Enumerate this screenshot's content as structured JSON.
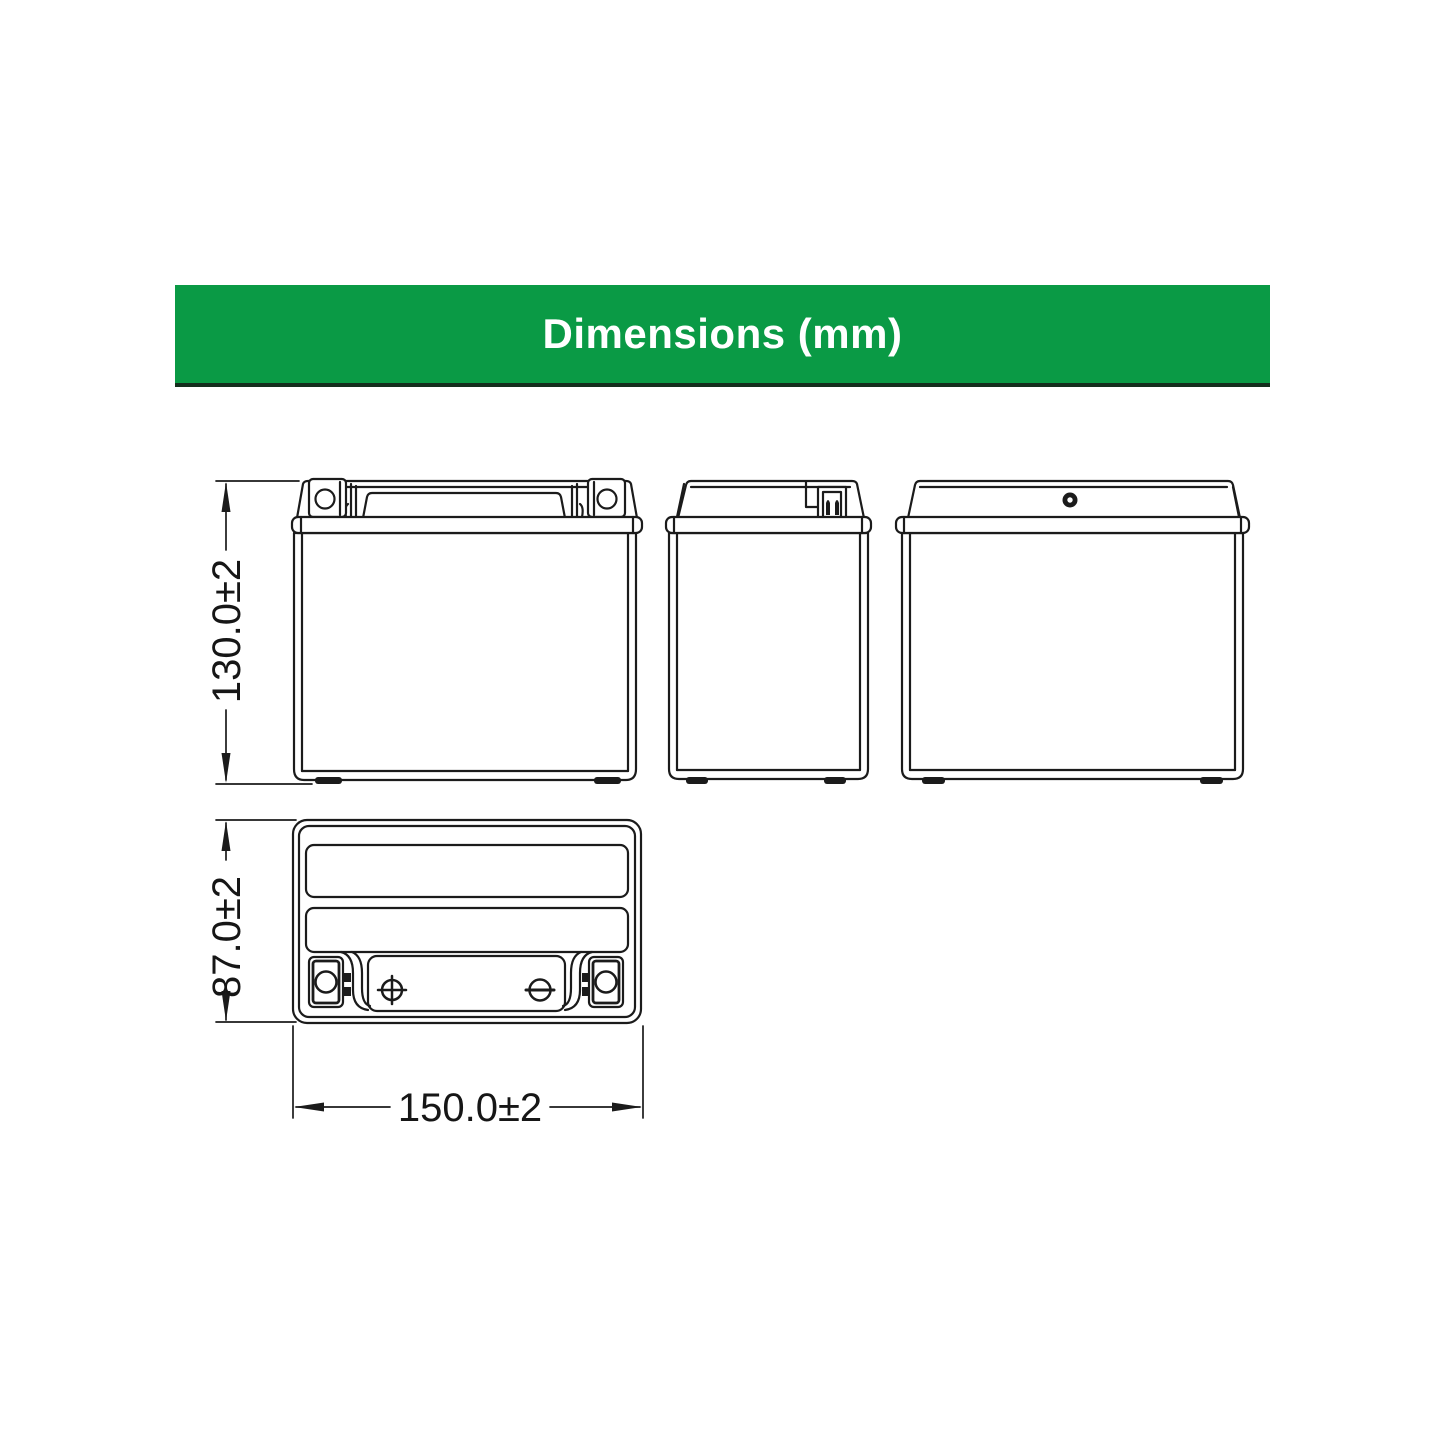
{
  "header": {
    "title": "Dimensions (mm)",
    "background_color": "#0a9a45",
    "underline_color": "#142e1d",
    "text_color": "#ffffff"
  },
  "drawing": {
    "line_color": "#1b1b1b",
    "dimensions": {
      "height": "130.0±2",
      "depth": "87.0±2",
      "width": "150.0±2"
    }
  }
}
